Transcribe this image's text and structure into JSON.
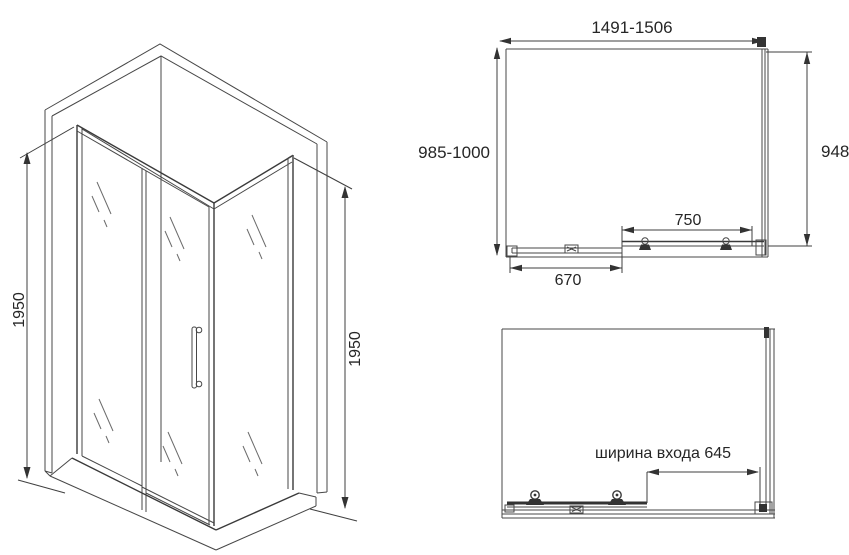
{
  "colors": {
    "background": "#ffffff",
    "line": "#474747",
    "dark_detail": "#333333",
    "text": "#262626"
  },
  "isometric_view": {
    "left_height_label": "1950",
    "right_height_label": "1950"
  },
  "top_view": {
    "overall_width_label": "1491-1506",
    "depth_label": "985-1000",
    "side_panel_label": "948",
    "door_width_label": "750",
    "fixed_panel_label": "670"
  },
  "front_view": {
    "entry_width_label": "ширина входа 645"
  }
}
